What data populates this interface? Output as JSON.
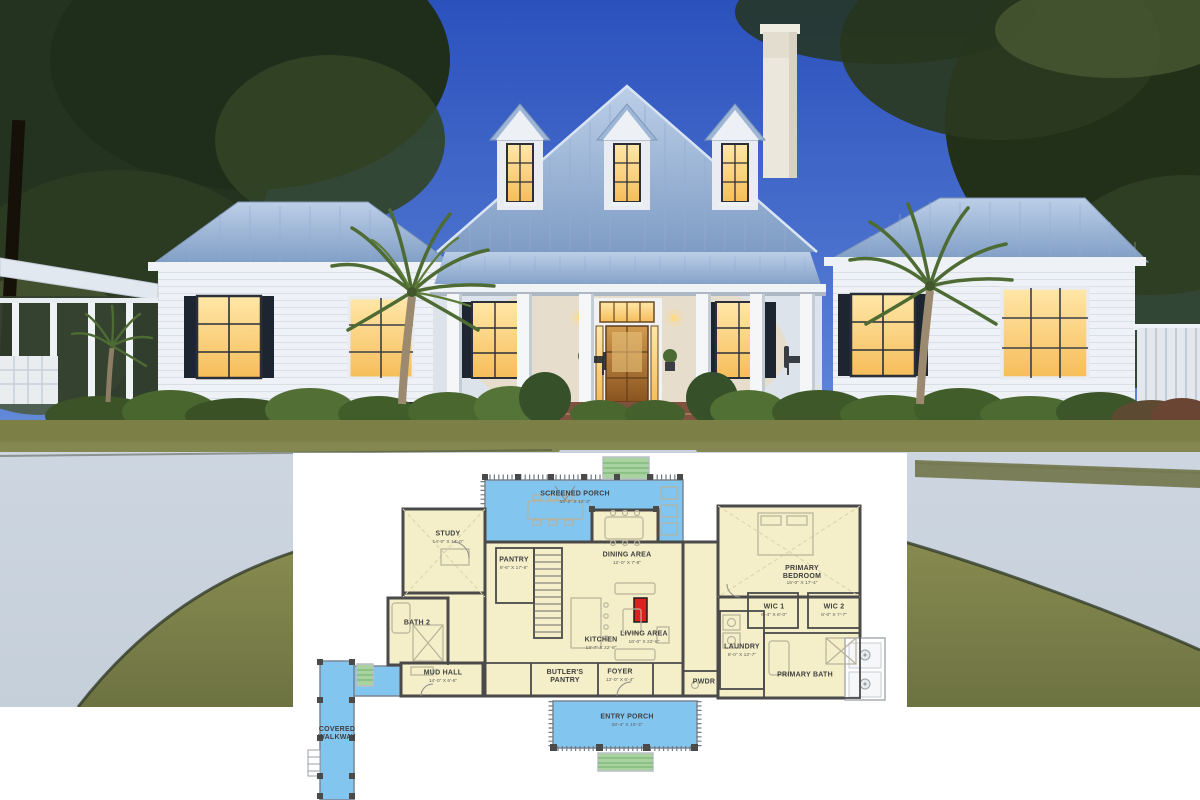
{
  "floor_plan": {
    "rooms": [
      {
        "id": "screened_porch",
        "label": "SCREENED PORCH",
        "dims": "55'-2\" X 12'-3\""
      },
      {
        "id": "study",
        "label": "STUDY",
        "dims": "14'-0\" X 14'-0\""
      },
      {
        "id": "pantry",
        "label": "PANTRY",
        "dims": "8'-6\" X 17'-6\""
      },
      {
        "id": "dining_area",
        "label": "DINING AREA",
        "dims": "12'-0\" X 7'-8\""
      },
      {
        "id": "bath_2",
        "label": "BATH 2",
        "dims": ""
      },
      {
        "id": "kitchen",
        "label": "KITCHEN",
        "dims": "13'-7\" X 22'-8\""
      },
      {
        "id": "living_area",
        "label": "LIVING AREA",
        "dims": "16'-0\" X 22'-8\""
      },
      {
        "id": "mud_hall",
        "label": "MUD HALL",
        "dims": "14'-0\" X 6'-6\""
      },
      {
        "id": "butlers_pantry",
        "label": "BUTLER'S PANTRY",
        "dims": ""
      },
      {
        "id": "foyer",
        "label": "FOYER",
        "dims": "12'-0\" X 6'-4\""
      },
      {
        "id": "pwdr",
        "label": "PWDR",
        "dims": ""
      },
      {
        "id": "laundry",
        "label": "LAUNDRY",
        "dims": "8'-0\" X 12'-7\""
      },
      {
        "id": "primary_bedroom",
        "label": "PRIMARY BEDROOM",
        "dims": "16'-0\" X 17'-4\""
      },
      {
        "id": "wic_1",
        "label": "WIC 1",
        "dims": "6'-4\" X 8'-0\""
      },
      {
        "id": "wic_2",
        "label": "WIC 2",
        "dims": "8'-0\" X 7'-7\""
      },
      {
        "id": "primary_bath",
        "label": "PRIMARY BATH",
        "dims": ""
      },
      {
        "id": "entry_porch",
        "label": "ENTRY PORCH",
        "dims": "28'-4\" X 10'-3\""
      },
      {
        "id": "covered_walkway",
        "label": "COVERED WALKWAY",
        "dims": ""
      }
    ]
  },
  "palette": {
    "sky_top": "#2b51bd",
    "sky_mid": "#5b82d6",
    "sky_bottom": "#a9c8f0",
    "foliage": "#24331e",
    "roof_light": "#bccfe8",
    "roof_dark": "#7e9cc4",
    "wall_white": "#eef1f5",
    "window_glow": "#f6bd5a",
    "window_glow_light": "#ffe7a8",
    "shutter": "#1d2531",
    "door_wood": "#a8672a",
    "brick": "#7f5240",
    "hedge": "#46602f",
    "lawn": "#7c7f46",
    "driveway": "#c5cfda",
    "plan_room": "#f4efc9",
    "plan_porch": "#82c5ef",
    "plan_steps": "#a8d3a1",
    "plan_wall": "#4a4a4a",
    "plan_text": "#3f3f3f",
    "plan_fireplace": "#e01f1f",
    "plan_furniture": "#b9b29a"
  }
}
